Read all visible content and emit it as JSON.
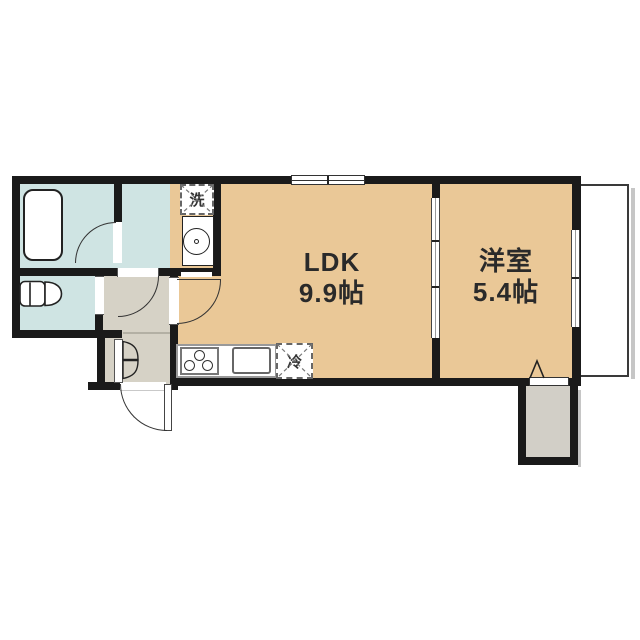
{
  "meta": {
    "type": "apartment-floor-plan"
  },
  "rooms": {
    "ldk": {
      "name": "LDK",
      "size": "9.9帖"
    },
    "bedroom": {
      "name": "洋室",
      "size": "5.4帖"
    }
  },
  "fixtures": {
    "washer_label": "洗",
    "fridge_label": "冷"
  },
  "colors": {
    "wall": "#1a1a1a",
    "room_main": "#eac897",
    "room_wet": "#cfe4e3",
    "room_hall": "#d6d2c6",
    "storage": "#d2cfc7",
    "outline": "#2a2a2a",
    "bg": "#ffffff"
  }
}
